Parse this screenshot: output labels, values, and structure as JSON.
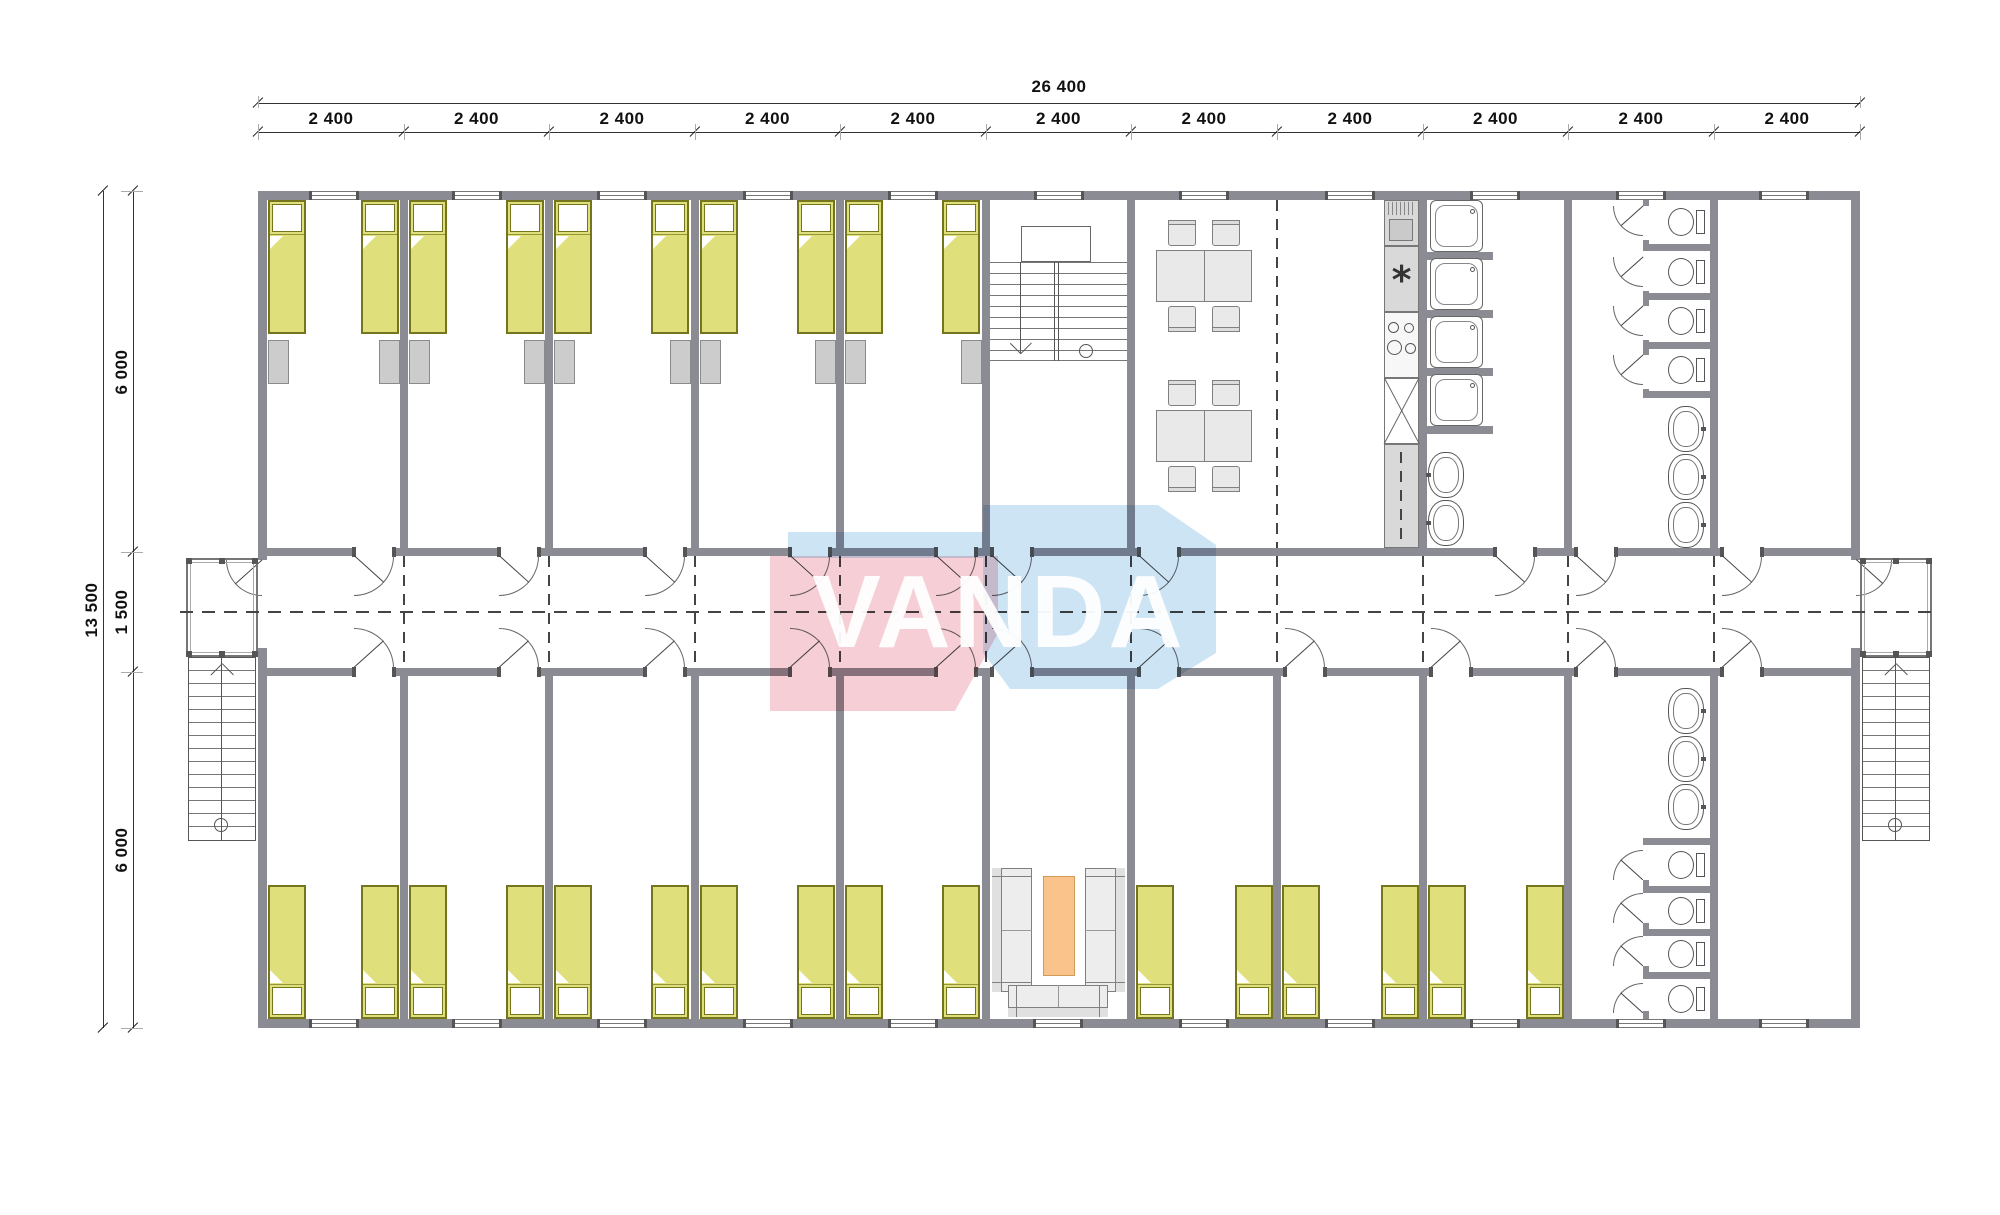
{
  "watermark": {
    "text": "VANDA",
    "blue": "#c9e2f4",
    "pink": "#f5cbd2"
  },
  "dimensions": {
    "top": {
      "overall": "26 400",
      "segments": [
        "2 400",
        "2 400",
        "2 400",
        "2 400",
        "2 400",
        "2 400",
        "2 400",
        "2 400",
        "2 400",
        "2 400",
        "2 400"
      ]
    },
    "left": {
      "overall": "13 500",
      "segments": [
        "6 000",
        "1 500",
        "6 000"
      ]
    }
  },
  "colors": {
    "wall": "#8b8b93",
    "line": "#555555",
    "lite": "#777777",
    "bed": "#dfe07b",
    "bedBorder": "#74751c",
    "wardrobe": "#cccccc",
    "wardrobeBorder": "#8a8a8a",
    "furn": "#e9e9e9",
    "furnBorder": "#808080",
    "orange": "#f9c38b",
    "orangeBorder": "#d19a58",
    "counter": "#d9d9d9",
    "dash": "#444444"
  },
  "plan": {
    "grid": [
      258,
      404,
      549,
      695,
      840,
      986,
      1131,
      1277,
      1423,
      1568,
      1714,
      1860
    ],
    "walls": [
      [
        258,
        191,
        1602,
        9
      ],
      [
        258,
        1019,
        1602,
        9
      ],
      [
        258,
        200,
        9,
        360
      ],
      [
        258,
        648,
        9,
        371
      ],
      [
        1851,
        200,
        9,
        360
      ],
      [
        1851,
        648,
        9,
        371
      ],
      [
        267,
        548,
        87,
        8
      ],
      [
        394,
        548,
        105,
        8
      ],
      [
        539,
        548,
        106,
        8
      ],
      [
        685,
        548,
        105,
        8
      ],
      [
        830,
        548,
        106,
        8
      ],
      [
        976,
        548,
        16,
        8
      ],
      [
        1032,
        548,
        107,
        8
      ],
      [
        1179,
        548,
        316,
        8
      ],
      [
        1535,
        548,
        41,
        8
      ],
      [
        1616,
        548,
        106,
        8
      ],
      [
        1762,
        548,
        89,
        8
      ],
      [
        267,
        668,
        87,
        8
      ],
      [
        394,
        668,
        105,
        8
      ],
      [
        539,
        668,
        106,
        8
      ],
      [
        685,
        668,
        105,
        8
      ],
      [
        830,
        668,
        106,
        8
      ],
      [
        976,
        668,
        16,
        8
      ],
      [
        1032,
        668,
        107,
        8
      ],
      [
        1179,
        668,
        106,
        8
      ],
      [
        1325,
        668,
        106,
        8
      ],
      [
        1471,
        668,
        105,
        8
      ],
      [
        1616,
        668,
        106,
        8
      ],
      [
        1762,
        668,
        89,
        8
      ],
      [
        400,
        200,
        8,
        348
      ],
      [
        545,
        200,
        8,
        348
      ],
      [
        691,
        200,
        8,
        348
      ],
      [
        836,
        200,
        8,
        348
      ],
      [
        982,
        200,
        8,
        348
      ],
      [
        1127,
        200,
        8,
        348
      ],
      [
        1419,
        200,
        8,
        348
      ],
      [
        1564,
        200,
        8,
        348
      ],
      [
        1710,
        200,
        8,
        348
      ],
      [
        400,
        676,
        8,
        343
      ],
      [
        545,
        676,
        8,
        343
      ],
      [
        691,
        676,
        8,
        343
      ],
      [
        836,
        676,
        8,
        343
      ],
      [
        982,
        676,
        8,
        343
      ],
      [
        1127,
        676,
        8,
        343
      ],
      [
        1273,
        676,
        8,
        343
      ],
      [
        1419,
        676,
        8,
        343
      ],
      [
        1564,
        676,
        8,
        343
      ],
      [
        1710,
        676,
        8,
        343
      ],
      [
        1423,
        252,
        70,
        8
      ],
      [
        1423,
        310,
        70,
        8
      ],
      [
        1423,
        368,
        70,
        8
      ],
      [
        1423,
        426,
        70,
        8
      ],
      [
        1643,
        200,
        6,
        6
      ],
      [
        1643,
        240,
        6,
        11
      ],
      [
        1643,
        291,
        6,
        15
      ],
      [
        1643,
        340,
        6,
        15
      ],
      [
        1643,
        389,
        6,
        9
      ],
      [
        1649,
        244,
        61,
        7
      ],
      [
        1649,
        293,
        61,
        7
      ],
      [
        1649,
        342,
        61,
        7
      ],
      [
        1643,
        391,
        67,
        7
      ],
      [
        1643,
        838,
        67,
        7
      ],
      [
        1649,
        886,
        61,
        7
      ],
      [
        1649,
        929,
        61,
        7
      ],
      [
        1649,
        972,
        61,
        7
      ],
      [
        1643,
        880,
        6,
        13
      ],
      [
        1643,
        923,
        6,
        13
      ],
      [
        1643,
        966,
        6,
        13
      ],
      [
        1643,
        1011,
        6,
        8
      ]
    ],
    "windows_top": [
      310,
      453,
      598,
      744,
      889,
      1035,
      1180,
      1326,
      1471,
      1617,
      1760
    ],
    "windows_bottom": [
      310,
      453,
      598,
      744,
      889,
      1034,
      1180,
      1326,
      1471,
      1617,
      1760
    ],
    "window_w": 48,
    "beds_top": [
      268,
      361,
      409,
      506,
      554,
      651,
      700,
      797,
      845,
      942
    ],
    "beds_bottom": [
      268,
      361,
      409,
      506,
      554,
      651,
      700,
      797,
      845,
      942,
      1136,
      1235,
      1282,
      1381,
      1428,
      1526
    ],
    "bed_size": [
      38,
      134
    ],
    "wardrobes": [
      268,
      379,
      409,
      524,
      554,
      670,
      700,
      815,
      845,
      961
    ],
    "openings_top": [
      354,
      499,
      645,
      790,
      936,
      992,
      1139,
      1495,
      1576,
      1722
    ],
    "openings_bottom": [
      354,
      499,
      645,
      790,
      936,
      992,
      1139,
      1285,
      1431,
      1576,
      1722
    ],
    "doors": [
      [
        354,
        556,
        40,
        "se"
      ],
      [
        499,
        556,
        40,
        "se"
      ],
      [
        645,
        556,
        40,
        "se"
      ],
      [
        790,
        556,
        40,
        "se"
      ],
      [
        936,
        556,
        40,
        "se"
      ],
      [
        992,
        556,
        40,
        "se"
      ],
      [
        1139,
        556,
        40,
        "se"
      ],
      [
        1495,
        556,
        40,
        "se"
      ],
      [
        1576,
        556,
        40,
        "se"
      ],
      [
        1722,
        556,
        40,
        "se"
      ],
      [
        354,
        668,
        40,
        "ne"
      ],
      [
        499,
        668,
        40,
        "ne"
      ],
      [
        645,
        668,
        40,
        "ne"
      ],
      [
        790,
        668,
        40,
        "ne"
      ],
      [
        936,
        668,
        40,
        "ne"
      ],
      [
        992,
        668,
        40,
        "ne"
      ],
      [
        1139,
        668,
        40,
        "ne"
      ],
      [
        1285,
        668,
        40,
        "ne"
      ],
      [
        1431,
        668,
        40,
        "ne"
      ],
      [
        1576,
        668,
        40,
        "ne"
      ],
      [
        1722,
        668,
        40,
        "ne"
      ],
      [
        262,
        560,
        36,
        "sw"
      ],
      [
        1856,
        560,
        36,
        "se"
      ],
      [
        1643,
        206,
        30,
        "sw"
      ],
      [
        1643,
        257,
        30,
        "sw"
      ],
      [
        1643,
        306,
        30,
        "sw"
      ],
      [
        1643,
        355,
        30,
        "sw"
      ],
      [
        1643,
        880,
        30,
        "nw"
      ],
      [
        1643,
        923,
        30,
        "nw"
      ],
      [
        1643,
        966,
        30,
        "nw"
      ],
      [
        1643,
        1013,
        30,
        "nw"
      ]
    ],
    "showers": [
      [
        1430,
        200
      ],
      [
        1430,
        258
      ],
      [
        1430,
        316
      ],
      [
        1430,
        374
      ]
    ],
    "toilets": [
      [
        1668,
        208
      ],
      [
        1668,
        258
      ],
      [
        1668,
        307
      ],
      [
        1668,
        356
      ],
      [
        1668,
        851
      ],
      [
        1668,
        897
      ],
      [
        1668,
        940
      ],
      [
        1668,
        985
      ]
    ],
    "basins": [
      [
        1668,
        406,
        "r"
      ],
      [
        1668,
        454,
        "r"
      ],
      [
        1668,
        502,
        "r"
      ],
      [
        1668,
        688,
        "r"
      ],
      [
        1668,
        736,
        "r"
      ],
      [
        1668,
        784,
        "r"
      ],
      [
        1428,
        452,
        "l"
      ],
      [
        1428,
        500,
        "l"
      ]
    ],
    "dining_tables": [
      [
        1156,
        250
      ],
      [
        1156,
        410
      ]
    ],
    "sofas": [
      [
        992,
        868,
        40,
        124,
        "l"
      ],
      [
        1085,
        868,
        40,
        124,
        "r"
      ],
      [
        1008,
        985,
        100,
        32,
        "b"
      ]
    ],
    "coffee_table": [
      1043,
      876,
      32,
      100
    ],
    "stair_in": {
      "x": 990,
      "w": 137,
      "treads": [
        262,
        273,
        284,
        295,
        306,
        317,
        328,
        339,
        350
      ],
      "divider": [
        1054,
        262,
        5,
        99
      ],
      "landing": [
        1021,
        226,
        70,
        36
      ],
      "arrow": [
        1020,
        262,
        92
      ],
      "circle": [
        1079,
        344,
        14
      ],
      "base": [
        990,
        360,
        137
      ]
    },
    "stairs_out": [
      {
        "x": 188,
        "y": 657,
        "w": 68,
        "h": 184,
        "cx": 221,
        "circ": [
          214,
          818
        ]
      },
      {
        "x": 1862,
        "y": 657,
        "w": 68,
        "h": 184,
        "cx": 1895,
        "circ": [
          1888,
          818
        ]
      }
    ],
    "porches": [
      [
        186,
        558,
        72,
        99
      ],
      [
        1860,
        558,
        72,
        99
      ]
    ],
    "kitchen": {
      "x": 1384,
      "w": 35,
      "units": [
        [
          200,
          46,
          "fridge"
        ],
        [
          246,
          66,
          "star"
        ],
        [
          312,
          66,
          "hob"
        ],
        [
          378,
          66,
          "x"
        ],
        [
          444,
          104,
          "counter"
        ]
      ],
      "hob_circles": [
        [
          1388,
          322,
          11
        ],
        [
          1404,
          323,
          10
        ],
        [
          1387,
          340,
          15
        ],
        [
          1405,
          343,
          11
        ]
      ]
    },
    "dash_h": [
      [
        180,
        611,
        1760
      ]
    ],
    "dash_v": [
      [
        404,
        556,
        112
      ],
      [
        549,
        556,
        112
      ],
      [
        695,
        556,
        112
      ],
      [
        840,
        556,
        112
      ],
      [
        986,
        556,
        112
      ],
      [
        1131,
        556,
        112
      ],
      [
        1277,
        556,
        112
      ],
      [
        1423,
        556,
        112
      ],
      [
        1568,
        556,
        112
      ],
      [
        1714,
        556,
        112
      ],
      [
        1277,
        200,
        348
      ]
    ],
    "counter_dash": [
      1401,
      452,
      88
    ],
    "dim_top": {
      "line1_y": 103,
      "line2_y": 132,
      "x1": 258,
      "x2": 1860
    },
    "dim_left": {
      "line1_x": 103,
      "line2_x": 133,
      "y1": 191,
      "y2": 1028,
      "ticks": [
        191,
        552,
        672,
        1028
      ]
    }
  }
}
